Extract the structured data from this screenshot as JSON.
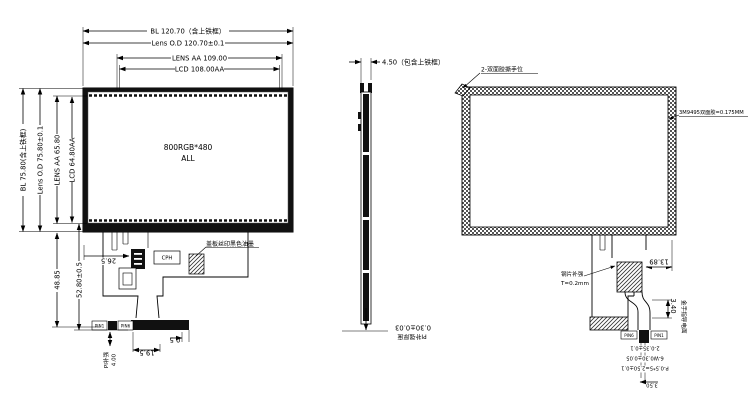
{
  "front": {
    "dims_top": {
      "bl": "BL 120.70（含上铁框）",
      "lens_od": "Lens O.D 120.70±0.1",
      "lens_aa": "LENS AA 109.00",
      "lcd": "LCD 108.00AA"
    },
    "dims_left": {
      "bl": "BL 75.80(含上铁框)",
      "lens_od": "Lens O.D 75.80±0.1",
      "lens_aa": "LENS AA 65.80",
      "lcd": "LCD 64.80AA"
    },
    "panel": {
      "line1": "800RGB*480",
      "line2": "ALL"
    },
    "note_ink": "盖板丝印黑色油墨",
    "fpc": {
      "dim_offset": "26.5",
      "dim_len": "48.85",
      "dim_len2": "52.80±0.5",
      "dim_tail_w": "19.5",
      "dim_end": "0.5",
      "dim_pi": "4.00",
      "pi_label": "PI补强",
      "ic_label": "CPH",
      "pin_first": "PIN1",
      "pin_last": "PIN6"
    }
  },
  "side": {
    "dim_thickness": "4.50（包含上铁框）",
    "dim_fpc": "0.30±0.03",
    "fpc_label": "PI补强厚度"
  },
  "back": {
    "note_tab": "2-双面胶撕手位",
    "note_tape": "3M9495双面胶=0.175MM",
    "steel_note1": "钢片补强",
    "steel_note2": "T=0.2mm",
    "dim_tail": "13.89",
    "dim_conn": "3.40",
    "gold_label": "金手指导电面",
    "dim_hole": "2-0.35±0.1",
    "dim_pad": "6-W0.30±0.05",
    "dim_pitch": "P-0.5*5=2.50±0.1",
    "dim_end": "3.50",
    "pin_first": "PIN6",
    "pin_last": "PIN1"
  }
}
